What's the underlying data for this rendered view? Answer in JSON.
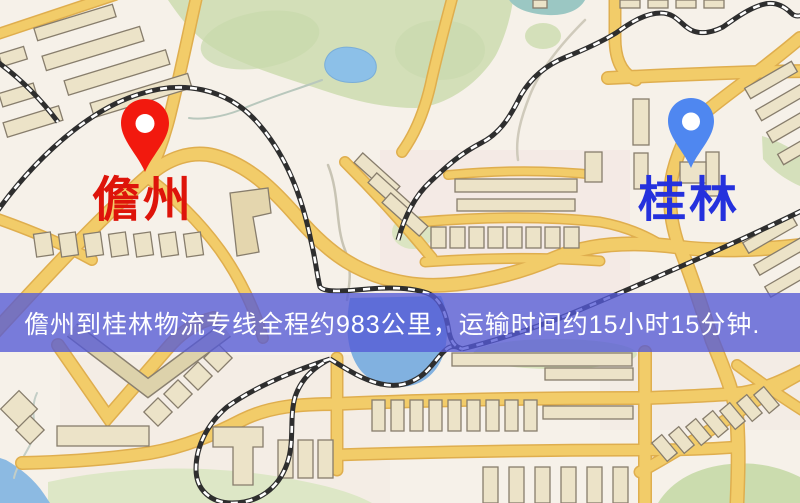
{
  "page": {
    "type": "logistics-route-map",
    "width": 800,
    "height": 503
  },
  "map": {
    "origin": {
      "label": "儋州",
      "marker_icon": "red-map-pin-icon",
      "marker_color": "#f2190e",
      "label_color": "#de140a"
    },
    "destination": {
      "label": "桂林",
      "marker_icon": "blue-map-pin-icon",
      "marker_color": "#4f87f0",
      "label_color": "#2531dd"
    },
    "route_banner": {
      "text": "儋州到桂林物流专线全程约983公里，运输时间约15小时15分钟.",
      "distance_km": 983,
      "duration": "15小时15分钟",
      "background": "rgba(84,90,214,0.78)",
      "text_color": "#ffffff"
    },
    "palette": {
      "background": "#f6f1e9",
      "road_fill": "#f2cc69",
      "road_casing": "#dfae4e",
      "park_green": "#d3dfb8",
      "water_blue": "#8cbae2",
      "building_fill": "#ece3c8",
      "building_stroke": "#877d6c",
      "railway": "#2e2e2e"
    }
  }
}
